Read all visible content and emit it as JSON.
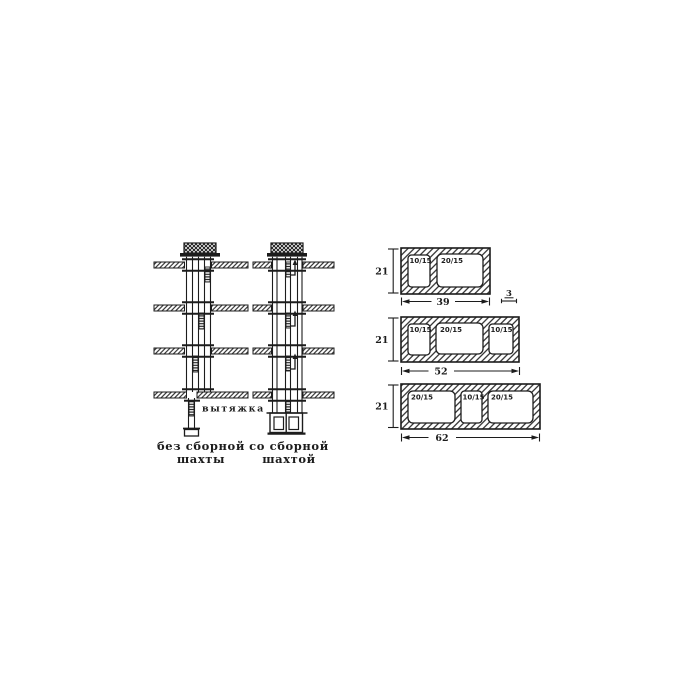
{
  "colors": {
    "background": "#ffffff",
    "ink": "#1c1c1c"
  },
  "shaft_diagrams": {
    "exhaust_label": "вытяжка",
    "without_collector": {
      "caption_line1": "без сборной",
      "caption_line2": "шахты"
    },
    "with_collector": {
      "caption_line1": "со сборной",
      "caption_line2": "шахтой"
    }
  },
  "vent_blocks": {
    "wall_thickness_label": "3",
    "blocks": [
      {
        "height_label": "21",
        "width_label": "39",
        "cells": [
          "10/15",
          "20/15"
        ]
      },
      {
        "height_label": "21",
        "width_label": "52",
        "cells": [
          "10/15",
          "20/15",
          "10/15"
        ]
      },
      {
        "height_label": "21",
        "width_label": "62",
        "cells": [
          "20/15",
          "10/15",
          "20/15"
        ]
      }
    ]
  }
}
